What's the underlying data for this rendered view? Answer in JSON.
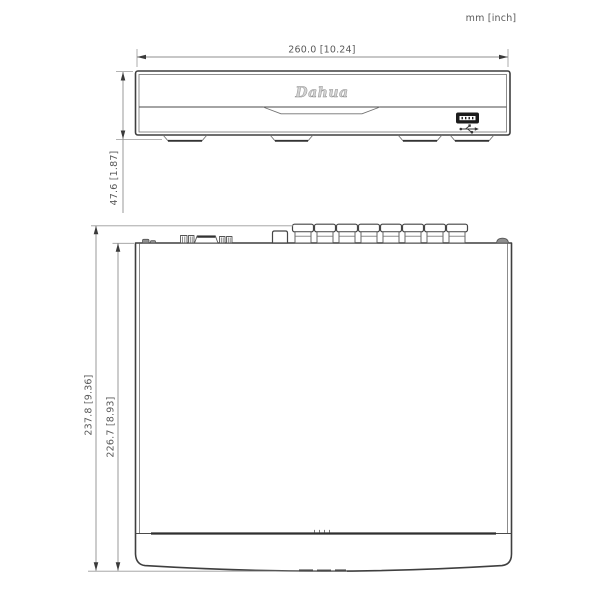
{
  "units_label": "mm [inch]",
  "front_view": {
    "width_dim_label": "260.0 [10.24]",
    "height_dim_label": "47.6 [1.87]",
    "logo_text": "Dahua"
  },
  "top_view": {
    "overall_depth_dim_label": "237.8 [9.36]",
    "body_depth_dim_label": "226.7 [8.93]"
  },
  "icons": {
    "usb_port": "usb-port-icon",
    "usb_symbol": "usb-trident-icon"
  },
  "colors": {
    "outline": "#3f3f3f",
    "dimline": "#8f8f8f",
    "text": "#5a5a5a",
    "usb": "#1c1c1c",
    "logo": "#d2d2d2",
    "heavy": "#2f2f2f"
  }
}
